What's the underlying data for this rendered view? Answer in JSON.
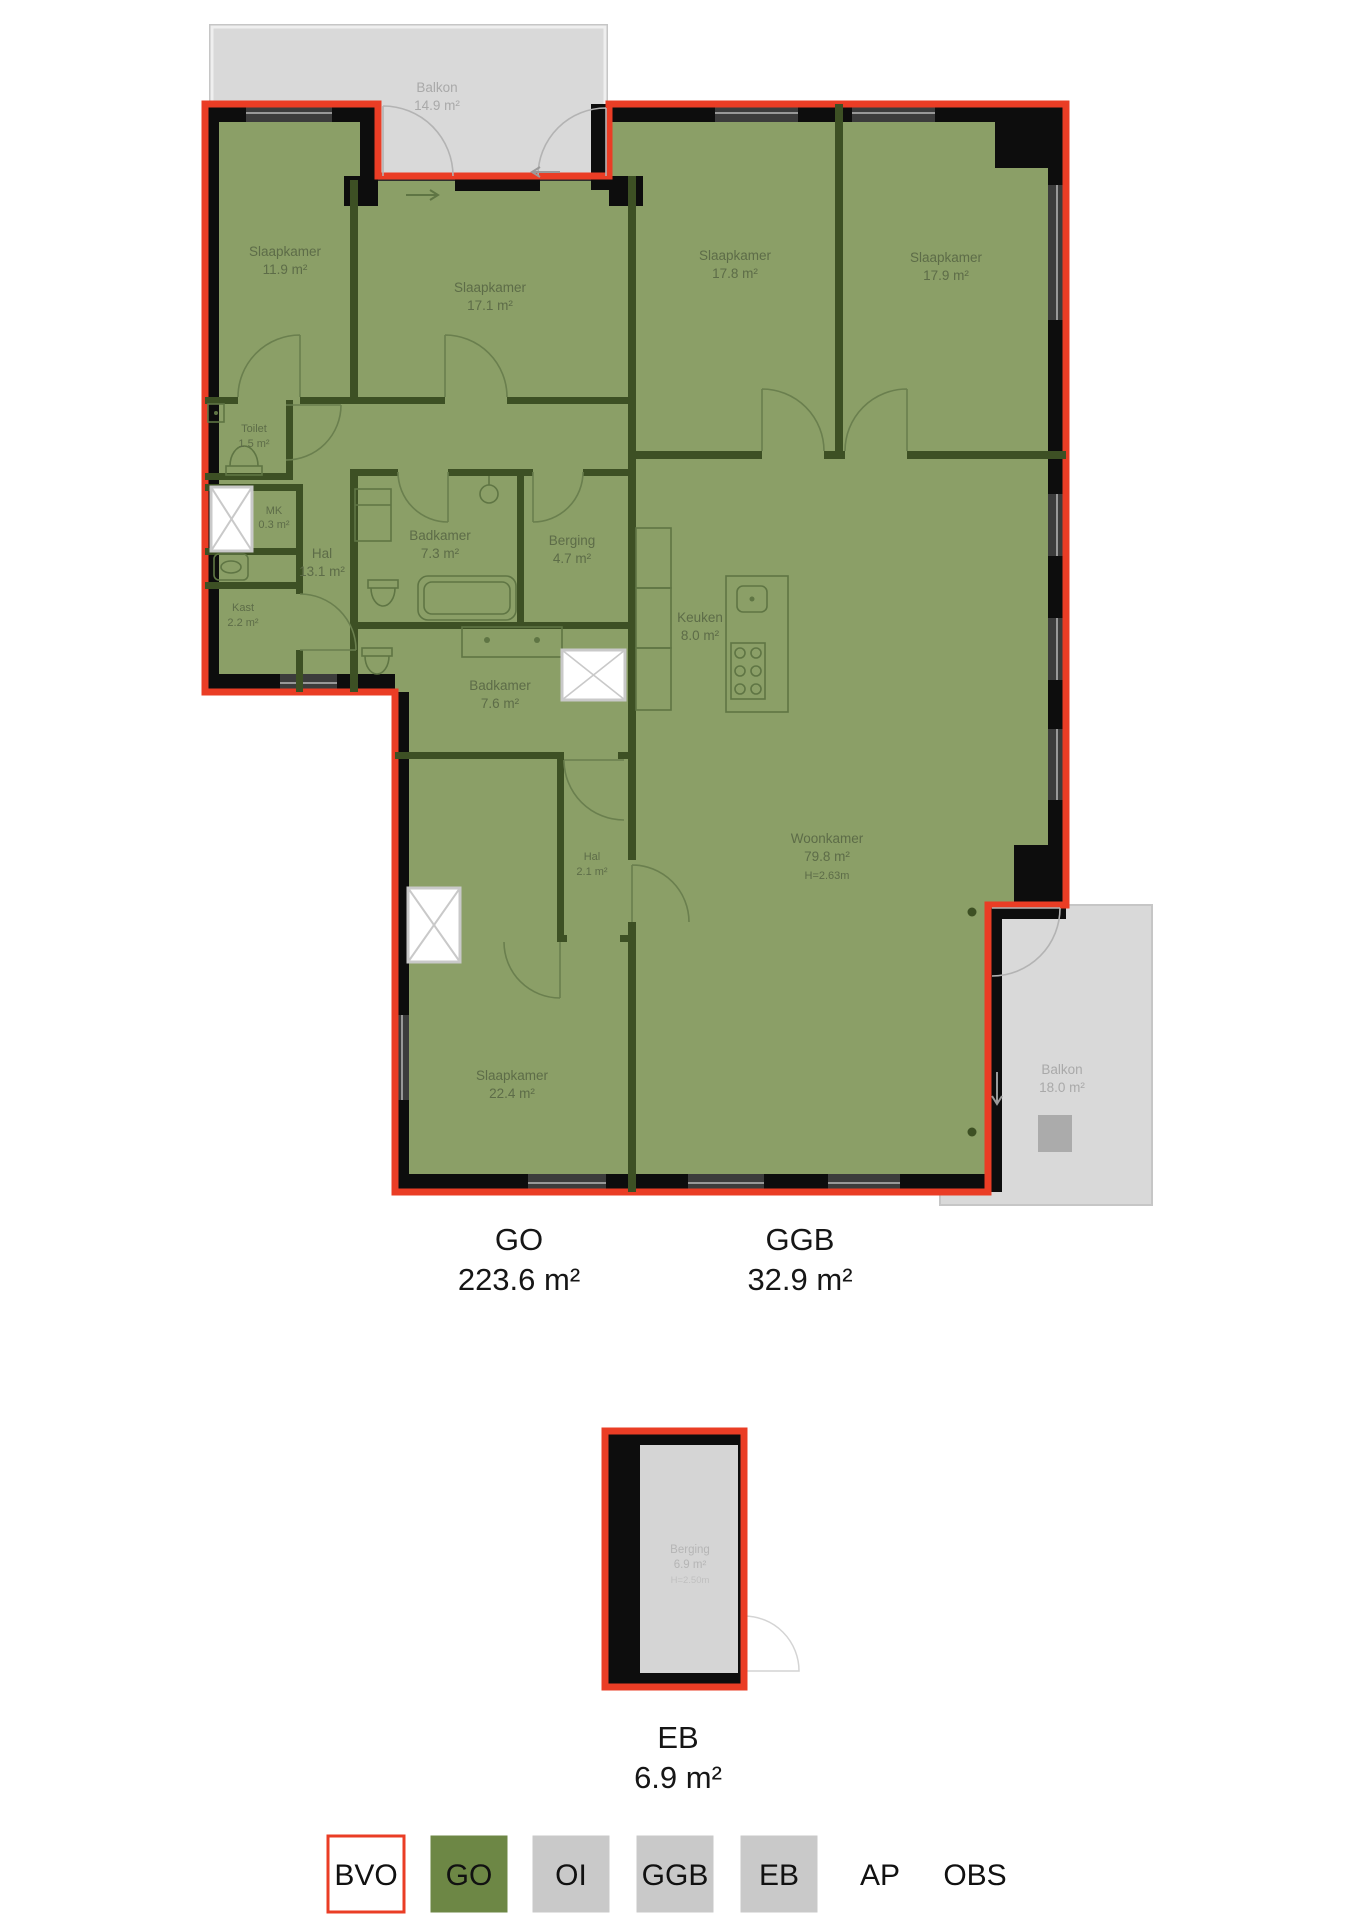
{
  "colors": {
    "bvo_outline": "#ea3d25",
    "go_fill": "#8b9f67",
    "outer_wall": "#0d0d0d",
    "interior_wall": "#3d5024",
    "balcony_fill": "#d9d9d9",
    "legend_green": "#6d8745",
    "legend_gray": "#c9c9c9"
  },
  "rooms": [
    {
      "name": "Slaapkamer",
      "area": "11.9 m²"
    },
    {
      "name": "Slaapkamer",
      "area": "17.1 m²"
    },
    {
      "name": "Slaapkamer",
      "area": "17.8 m²"
    },
    {
      "name": "Slaapkamer",
      "area": "17.9 m²"
    },
    {
      "name": "Toilet",
      "area": "1.5 m²"
    },
    {
      "name": "MK",
      "area": "0.3 m²"
    },
    {
      "name": "Hal",
      "area": "13.1 m²"
    },
    {
      "name": "Badkamer",
      "area": "7.3 m²"
    },
    {
      "name": "Kast",
      "area": "2.2 m²"
    },
    {
      "name": "Berging",
      "area": "4.7 m²"
    },
    {
      "name": "Badkamer",
      "area": "7.6 m²"
    },
    {
      "name": "Keuken",
      "area": "8.0 m²"
    },
    {
      "name": "Hal",
      "area": "2.1 m²"
    },
    {
      "name": "Woonkamer",
      "area": "79.8 m²",
      "height": "H=2.63m"
    },
    {
      "name": "Slaapkamer",
      "area": "22.4 m²"
    }
  ],
  "balconies": [
    {
      "name": "Balkon",
      "area": "14.9 m²"
    },
    {
      "name": "Balkon",
      "area": "18.0 m²"
    }
  ],
  "storage_unit": {
    "name": "Berging",
    "area": "6.9 m²",
    "height": "H=2.50m"
  },
  "summary": [
    {
      "label": "GO",
      "area": "223.6 m²"
    },
    {
      "label": "GGB",
      "area": "32.9 m²"
    },
    {
      "label": "EB",
      "area": "6.9 m²"
    }
  ],
  "legend": {
    "items": [
      {
        "label": "BVO",
        "fill": "#ffffff",
        "stroke": "#ea3d25"
      },
      {
        "label": "GO",
        "fill": "#6d8745",
        "stroke": "#6d8745"
      },
      {
        "label": "OI",
        "fill": "#c9c9c9",
        "stroke": "#c9c9c9"
      },
      {
        "label": "GGB",
        "fill": "#c9c9c9",
        "stroke": "#c9c9c9"
      },
      {
        "label": "EB",
        "fill": "#c9c9c9",
        "stroke": "#c9c9c9"
      },
      {
        "label": "AP"
      },
      {
        "label": "OBS"
      }
    ]
  }
}
